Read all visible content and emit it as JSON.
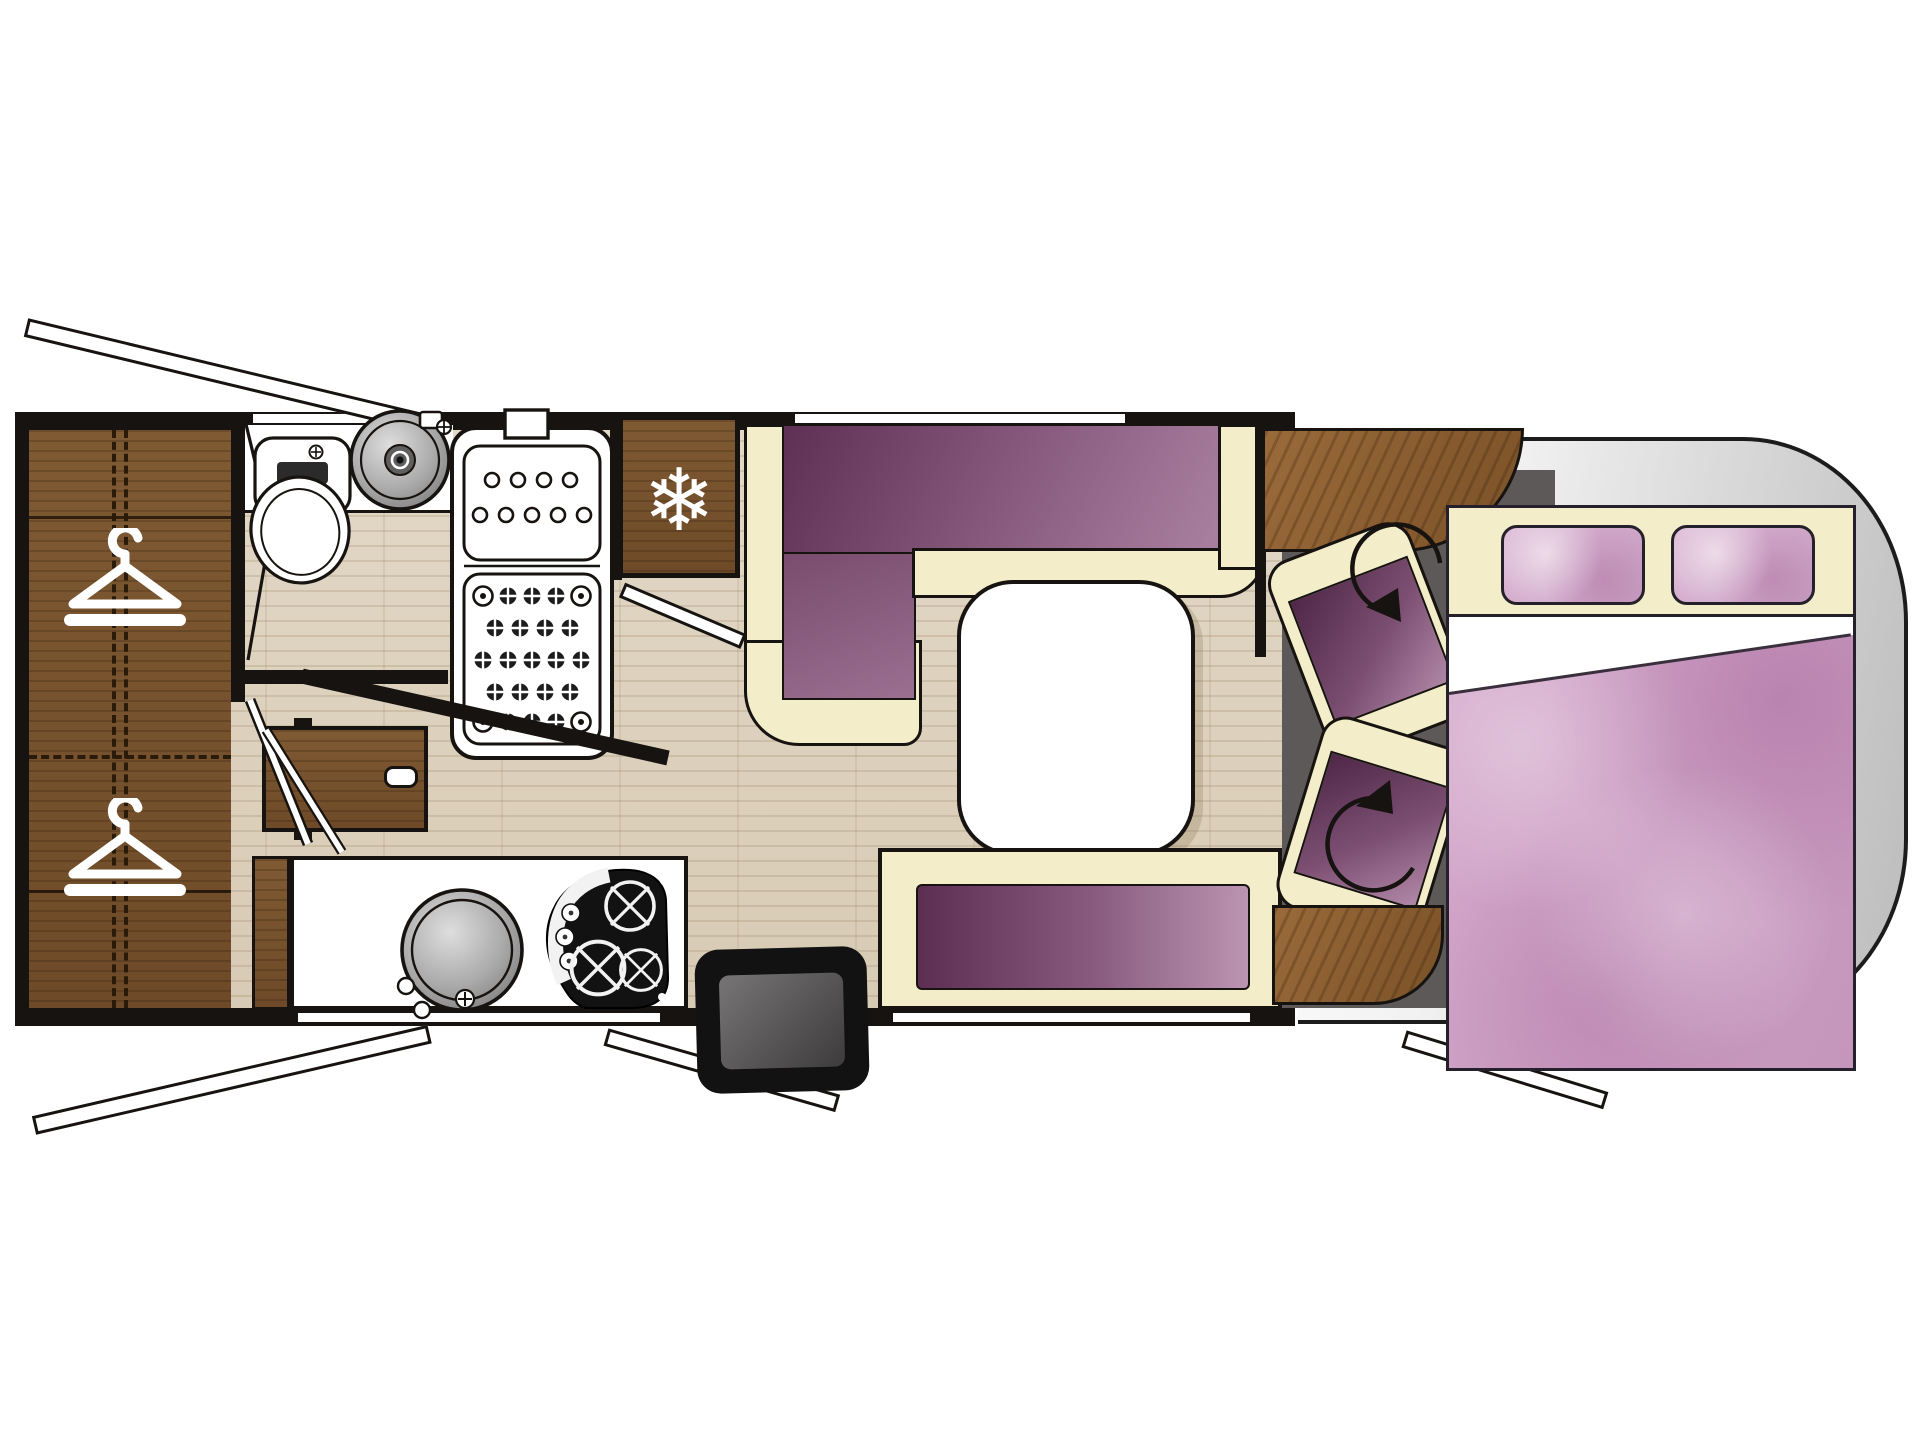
{
  "scene": {
    "kind": "motorhome-floorplan-top-view",
    "rooms": [
      "wardrobe",
      "bathroom",
      "shower",
      "kitchen",
      "dinette",
      "cab",
      "bedroom"
    ]
  },
  "fridge": {
    "snowflake_glyph": "❄"
  },
  "counts": {
    "hangers": 2,
    "pillows": 2,
    "swivel_seats": 2,
    "hob_burners": 3,
    "dinette_tables": 1
  },
  "icons": {
    "snowflake-icon": "fridge / freezer",
    "hanger-icon": "wardrobe clothes hanger",
    "rotation-arrow-icon": "swivel seat rotation",
    "burner-icon": "gas hob burner"
  },
  "colors": {
    "outline_black": "#171310",
    "cream_upholstery": "#f3edc9",
    "purple_dark": "#5e3154",
    "purple_light": "#ab81a1",
    "pink_bedding": "#d4a8cb",
    "wood_dark": "#7a5128",
    "wood_mid": "#96713f",
    "laminate_floor": "#ddd2bf",
    "cab_floor_gray": "#5d5959",
    "body_shell_gray": "#c9c9c9",
    "fixture_white": "#ffffff"
  }
}
